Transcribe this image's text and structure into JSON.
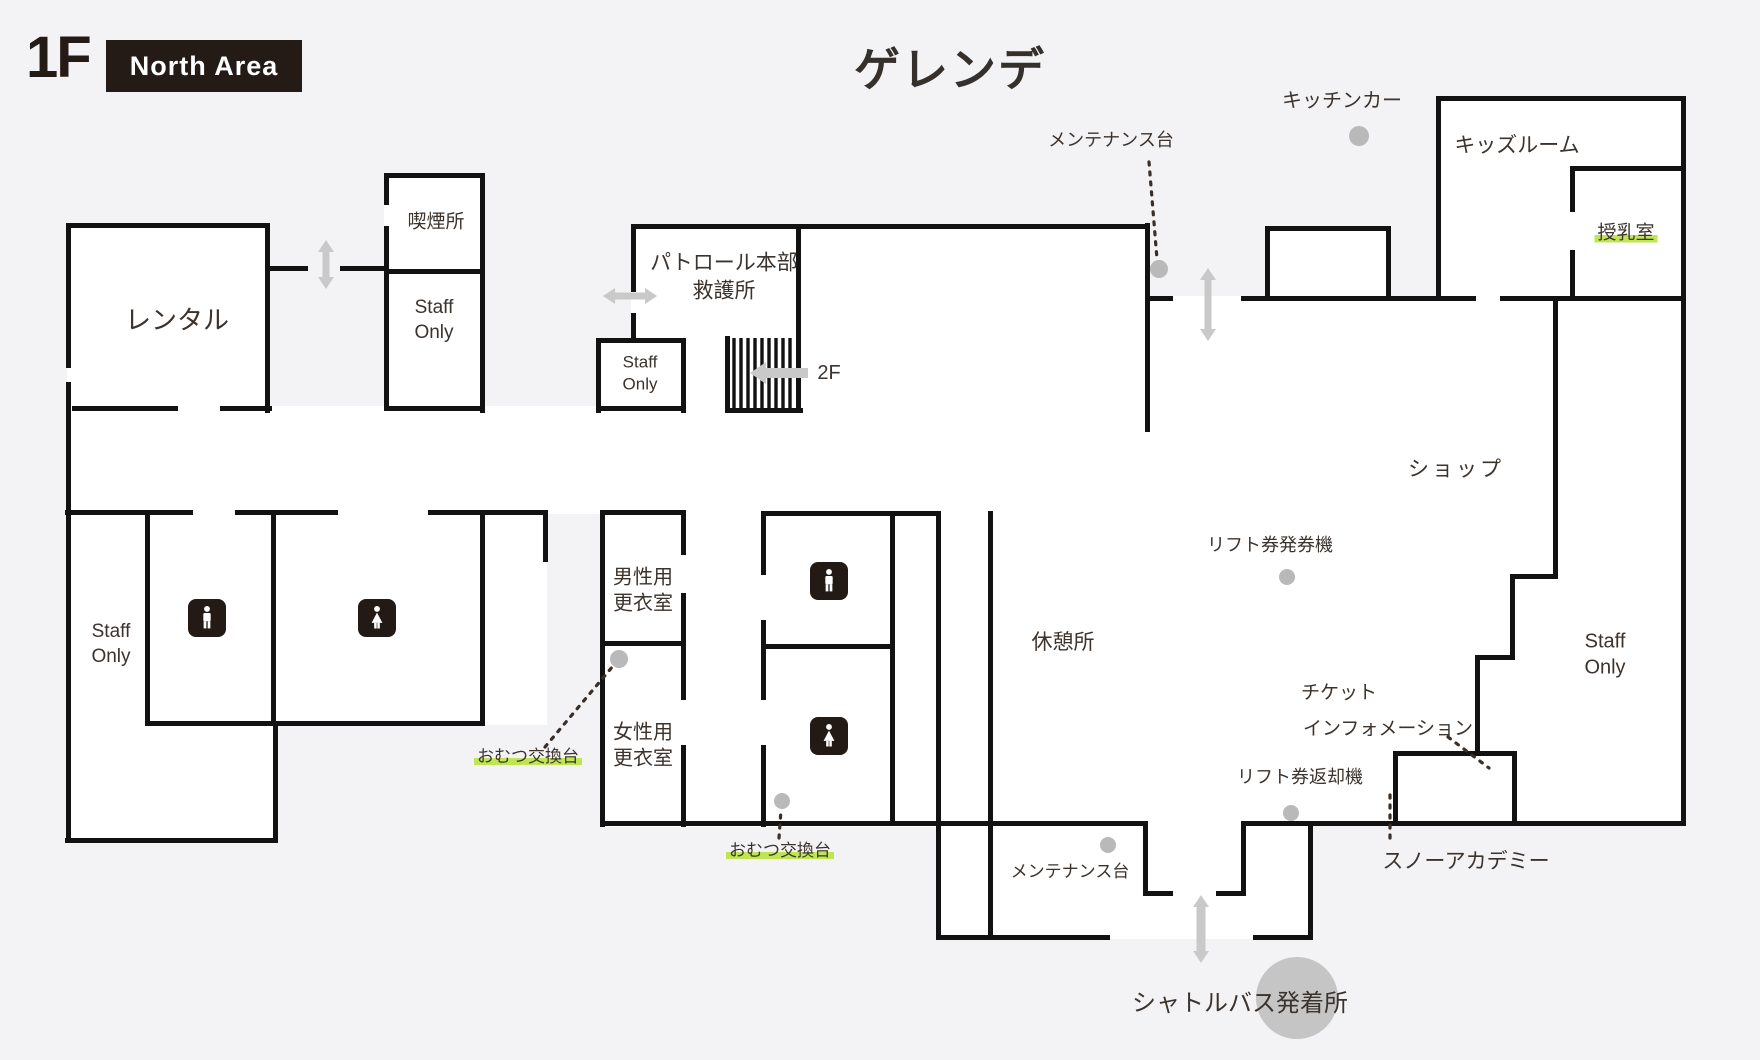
{
  "header": {
    "floor_label": "1F",
    "area_badge": "North Area",
    "map_title": "ゲレンデ"
  },
  "rooms": {
    "rental": "レンタル",
    "smoking": "喫煙所",
    "staff_only": "Staff\nOnly",
    "patrol": "パトロール本部\n救護所",
    "floor_2f": "2F",
    "kids_room": "キッズルーム",
    "nursing_room": "授乳室",
    "shop": "ショップ",
    "rest_area": "休憩所",
    "mens_changing": "男性用\n更衣室",
    "womens_changing": "女性用\n更衣室"
  },
  "annotations": {
    "kitchen_car": "キッチンカー",
    "maintenance_stand": "メンテナンス台",
    "lift_ticket_machine": "リフト券発券機",
    "ticket_line1": "チケット",
    "ticket_line2": "インフォメーション",
    "lift_ticket_return": "リフト券返却機",
    "snow_academy": "スノーアカデミー",
    "diaper_station": "おむつ交換台",
    "shuttle_bus": "シャトルバス発着所"
  },
  "colors": {
    "wall": "#121212",
    "background": "#f3f3f5",
    "room_fill": "#ffffff",
    "highlight_green": "#bfe554",
    "marker_gray": "#b9b9b9",
    "arrow_gray": "#c9c9c9",
    "badge_bg": "#241b16"
  }
}
